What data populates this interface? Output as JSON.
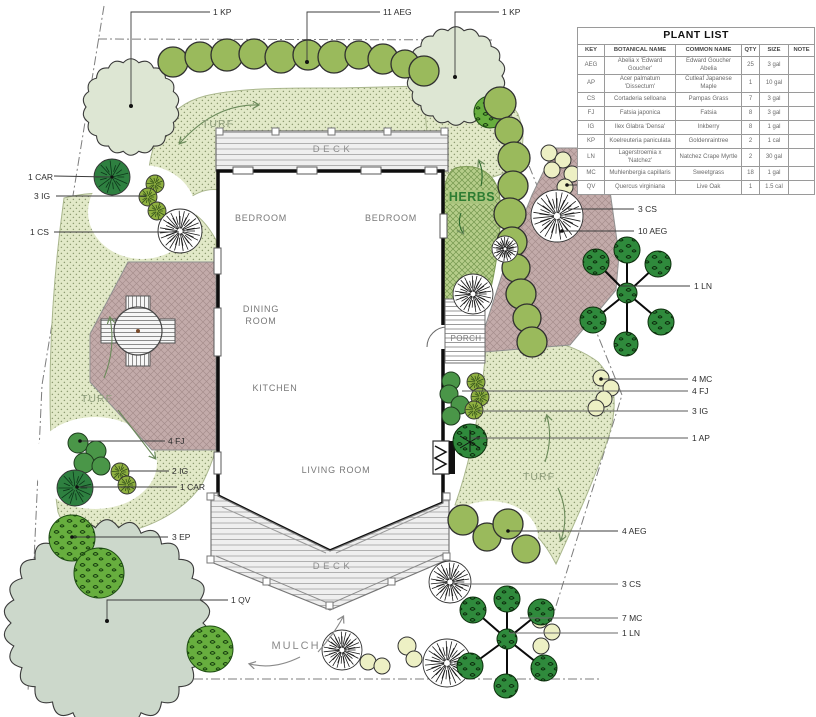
{
  "plant_list": {
    "title": "PLANT LIST",
    "columns": [
      "KEY",
      "BOTANICAL NAME",
      "COMMON NAME",
      "QTY",
      "SIZE",
      "NOTE"
    ],
    "rows": [
      {
        "key": "AEG",
        "botanical": "Abelia x 'Edward Goucher'",
        "common": "Edward Goucher Abelia",
        "qty": "25",
        "size": "3 gal",
        "note": ""
      },
      {
        "key": "AP",
        "botanical": "Acer palmatum 'Dissectum'",
        "common": "Cutleaf Japanese Maple",
        "qty": "1",
        "size": "10 gal",
        "note": ""
      },
      {
        "key": "CS",
        "botanical": "Cortaderia selloana",
        "common": "Pampas Grass",
        "qty": "7",
        "size": "3 gal",
        "note": ""
      },
      {
        "key": "FJ",
        "botanical": "Fatsia japonica",
        "common": "Fatsia",
        "qty": "8",
        "size": "3 gal",
        "note": ""
      },
      {
        "key": "IG",
        "botanical": "Ilex Glabra 'Densa'",
        "common": "Inkberry",
        "qty": "8",
        "size": "1 gal",
        "note": ""
      },
      {
        "key": "KP",
        "botanical": "Koelreuteria paniculata",
        "common": "Goldenraintree",
        "qty": "2",
        "size": "1 cal",
        "note": ""
      },
      {
        "key": "LN",
        "botanical": "Lagerstroemia x 'Natchez'",
        "common": "Natchez Crape Myrtle",
        "qty": "2",
        "size": "30 gal",
        "note": ""
      },
      {
        "key": "MC",
        "botanical": "Muhlenbergia capillaris",
        "common": "Sweetgrass",
        "qty": "18",
        "size": "1 gal",
        "note": ""
      },
      {
        "key": "QV",
        "botanical": "Quercus virginiana",
        "common": "Live Oak",
        "qty": "1",
        "size": "1.5 cal",
        "note": ""
      }
    ]
  },
  "rooms": {
    "bedroom1": "BEDROOM",
    "bedroom2": "BEDROOM",
    "dining1": "DINING",
    "dining2": "ROOM",
    "kitchen": "KITCHEN",
    "living": "LIVING ROOM",
    "porch": "PORCH"
  },
  "areas": {
    "turf": "TURF",
    "herbs": "HERBS",
    "mulch": "MULCH",
    "deck": "DECK"
  },
  "callouts": [
    {
      "text": "1 KP"
    },
    {
      "text": "11 AEG"
    },
    {
      "text": "1 KP"
    },
    {
      "text": "1 CAR"
    },
    {
      "text": "3 IG"
    },
    {
      "text": "1 CS"
    },
    {
      "text": "7 MC"
    },
    {
      "text": "3 CS"
    },
    {
      "text": "10 AEG"
    },
    {
      "text": "1 LN"
    },
    {
      "text": "4 MC"
    },
    {
      "text": "4 FJ"
    },
    {
      "text": "3 IG"
    },
    {
      "text": "1 AP"
    },
    {
      "text": "4 AEG"
    },
    {
      "text": "3 CS"
    },
    {
      "text": "7 MC"
    },
    {
      "text": "1 LN"
    },
    {
      "text": "4 FJ"
    },
    {
      "text": "2 IG"
    },
    {
      "text": "1 CAR"
    },
    {
      "text": "3 EP"
    },
    {
      "text": "1 QV"
    }
  ],
  "colors": {
    "turf": "#e2e9c8",
    "patio": "#c3abaa",
    "herbs": "#b6cd8a",
    "shrub_olive": "#9aba5c",
    "shrub_pale_yellow": "#edf0c4",
    "shrub_green": "#4a9648",
    "tree_pale": "#dde6d3",
    "tree_oak": "#ccd8cb",
    "deck": "#efefef",
    "herb_label": "#2e7d32"
  }
}
